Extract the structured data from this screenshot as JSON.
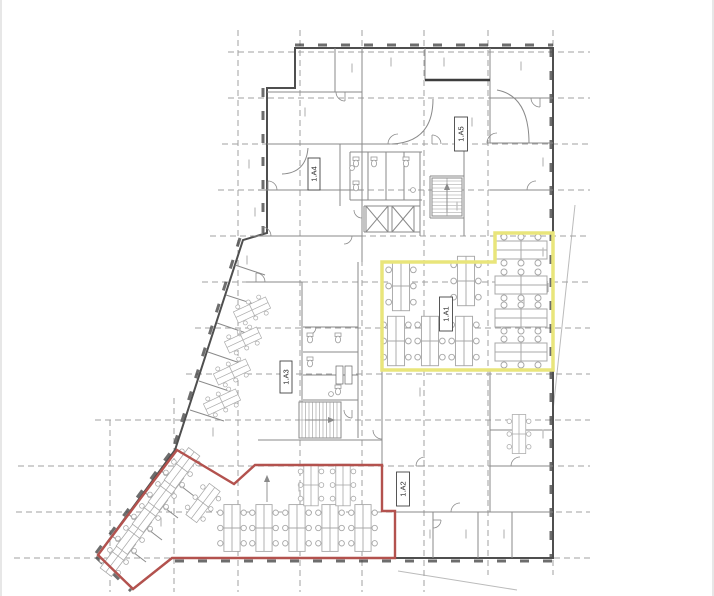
{
  "title": "architectural-floor-plan",
  "colors": {
    "background": "#ffffff",
    "grid": "#a0a0a0",
    "wall_exterior": "#4f4f4f",
    "wall_interior": "#8a8a8a",
    "wall_dark": "#3d3d3d",
    "furniture": "#a8a8a8",
    "zone_yellow": "#e9e57b",
    "zone_red": "#b3524e",
    "label_text": "#2b2b2b",
    "label_box_border": "#444444",
    "site_line": "#bbbbbb",
    "micro": "#bfbfbf",
    "fixture": "#9a9a9a",
    "page_edge": "#e7e7e7"
  },
  "grid": {
    "verticals": [
      {
        "x": 238,
        "y1": 30,
        "y2": 592
      },
      {
        "x": 300,
        "y1": 30,
        "y2": 592
      },
      {
        "x": 362,
        "y1": 30,
        "y2": 592
      },
      {
        "x": 424,
        "y1": 30,
        "y2": 592
      },
      {
        "x": 488,
        "y1": 30,
        "y2": 575
      },
      {
        "x": 553,
        "y1": 30,
        "y2": 575
      },
      {
        "x": 174,
        "y1": 398,
        "y2": 592
      },
      {
        "x": 110,
        "y1": 420,
        "y2": 592
      }
    ],
    "horizontals": [
      {
        "y": 52,
        "x1": 228,
        "x2": 590
      },
      {
        "y": 98,
        "x1": 228,
        "x2": 590
      },
      {
        "y": 144,
        "x1": 222,
        "x2": 590
      },
      {
        "y": 190,
        "x1": 218,
        "x2": 590
      },
      {
        "y": 236,
        "x1": 210,
        "x2": 590
      },
      {
        "y": 282,
        "x1": 202,
        "x2": 590
      },
      {
        "y": 328,
        "x1": 195,
        "x2": 590
      },
      {
        "y": 374,
        "x1": 186,
        "x2": 590
      },
      {
        "y": 420,
        "x1": 95,
        "x2": 590
      },
      {
        "y": 466,
        "x1": 18,
        "x2": 590
      },
      {
        "y": 512,
        "x1": 16,
        "x2": 590
      },
      {
        "y": 558,
        "x1": 14,
        "x2": 590
      }
    ]
  },
  "outline": "M 295 48 L 553 48 L 553 558 L 172 558 L 133 589 L 98 555 L 175 450 L 243 240 L 267 233 L 267 88 L 295 88 Z",
  "window_strips": [
    [
      295,
      45,
      553,
      45
    ],
    [
      551,
      48,
      551,
      558
    ],
    [
      175,
      561,
      553,
      561
    ],
    [
      240,
      238,
      174,
      446
    ],
    [
      96,
      553,
      173,
      449
    ],
    [
      96,
      557,
      131,
      591
    ],
    [
      263,
      88,
      263,
      233
    ]
  ],
  "interior_walls": [
    [
      362,
      48,
      362,
      262
    ],
    [
      335,
      48,
      335,
      92
    ],
    [
      267,
      92,
      362,
      92
    ],
    [
      425,
      48,
      425,
      80
    ],
    [
      490,
      48,
      490,
      143
    ],
    [
      267,
      144,
      390,
      144
    ],
    [
      490,
      143,
      553,
      143
    ],
    [
      490,
      98,
      553,
      98
    ],
    [
      258,
      190,
      362,
      190
    ],
    [
      490,
      190,
      553,
      190
    ],
    [
      252,
      236,
      362,
      236
    ],
    [
      340,
      144,
      340,
      206
    ],
    [
      420,
      152,
      420,
      236
    ],
    [
      464,
      144,
      464,
      236
    ],
    [
      350,
      152,
      422,
      152
    ],
    [
      350,
      200,
      422,
      200
    ],
    [
      350,
      152,
      350,
      200
    ],
    [
      368,
      152,
      368,
      200
    ],
    [
      386,
      152,
      386,
      200
    ],
    [
      404,
      152,
      404,
      200
    ],
    [
      302,
      282,
      302,
      438
    ],
    [
      246,
      282,
      302,
      282
    ],
    [
      358,
      262,
      358,
      438
    ],
    [
      303,
      327,
      358,
      327
    ],
    [
      303,
      352,
      358,
      352
    ],
    [
      303,
      375,
      358,
      375
    ],
    [
      303,
      400,
      358,
      400
    ],
    [
      299,
      402,
      341,
      402
    ],
    [
      341,
      402,
      341,
      438
    ],
    [
      299,
      438,
      341,
      438
    ],
    [
      382,
      262,
      495,
      262
    ],
    [
      495,
      233,
      553,
      233
    ],
    [
      382,
      262,
      382,
      370
    ],
    [
      382,
      370,
      553,
      370
    ],
    [
      382,
      370,
      382,
      465
    ],
    [
      258,
      440,
      382,
      440
    ],
    [
      395,
      512,
      553,
      512
    ],
    [
      433,
      512,
      433,
      558
    ],
    [
      478,
      512,
      478,
      558
    ],
    [
      512,
      512,
      512,
      558
    ],
    [
      490,
      370,
      490,
      512
    ],
    [
      490,
      430,
      553,
      430
    ],
    [
      490,
      466,
      553,
      466
    ],
    [
      430,
      176,
      464,
      176
    ],
    [
      430,
      218,
      464,
      218
    ],
    [
      430,
      176,
      430,
      218
    ],
    [
      364,
      206,
      364,
      232
    ],
    [
      420,
      206,
      420,
      232
    ],
    [
      364,
      206,
      420,
      206
    ],
    [
      364,
      232,
      420,
      232
    ],
    [
      235,
      265,
      265,
      275
    ],
    [
      226,
      295,
      257,
      305
    ],
    [
      217,
      323,
      249,
      334
    ],
    [
      208,
      352,
      240,
      363
    ],
    [
      199,
      381,
      232,
      392
    ],
    [
      190,
      410,
      224,
      421
    ],
    [
      112,
      536,
      146,
      562
    ],
    [
      128,
      514,
      162,
      540
    ],
    [
      144,
      492,
      178,
      518
    ],
    [
      160,
      470,
      194,
      496
    ]
  ],
  "dark_walls": [
    [
      425,
      80,
      490,
      80
    ]
  ],
  "arcs": [
    "M 433 99 Q 433 142 392 144",
    "M 497 90 Q 529 96 529 143",
    "M 308 148 Q 306 173 282 174"
  ],
  "doors": [
    [
      345,
      92,
      9,
      90
    ],
    [
      398,
      144,
      10,
      180
    ],
    [
      432,
      144,
      9,
      270
    ],
    [
      497,
      143,
      10,
      180
    ],
    [
      536,
      190,
      9,
      180
    ],
    [
      268,
      190,
      9,
      270
    ],
    [
      262,
      236,
      9,
      270
    ],
    [
      256,
      282,
      9,
      270
    ],
    [
      362,
      210,
      8,
      90
    ],
    [
      344,
      236,
      8,
      0
    ],
    [
      308,
      327,
      8,
      0
    ],
    [
      352,
      410,
      8,
      90
    ],
    [
      382,
      430,
      9,
      90
    ],
    [
      425,
      466,
      9,
      180
    ],
    [
      460,
      512,
      9,
      180
    ],
    [
      433,
      520,
      8,
      0
    ],
    [
      520,
      466,
      9,
      180
    ],
    [
      548,
      283,
      9,
      90
    ],
    [
      540,
      98,
      9,
      90
    ]
  ],
  "stairs": [
    {
      "x": 432,
      "y": 178,
      "w": 30,
      "h": 38,
      "dir": "h"
    },
    {
      "x": 299,
      "y": 402,
      "w": 42,
      "h": 36,
      "dir": "v"
    }
  ],
  "elevators": [
    {
      "x": 366,
      "y": 206,
      "w": 22,
      "h": 26
    },
    {
      "x": 392,
      "y": 206,
      "w": 22,
      "h": 26
    }
  ],
  "fixtures": {
    "wc": [
      [
        356,
        162
      ],
      [
        356,
        186
      ],
      [
        374,
        162
      ],
      [
        406,
        162
      ],
      [
        310,
        338
      ],
      [
        310,
        362
      ],
      [
        338,
        338
      ],
      [
        338,
        390
      ]
    ],
    "basins": [
      [
        413,
        190
      ],
      [
        331,
        394
      ],
      [
        352,
        168
      ]
    ]
  },
  "desk_clusters": [
    {
      "cx": 521,
      "cy": 250,
      "rot": 0,
      "s": 1
    },
    {
      "cx": 521,
      "cy": 285,
      "rot": 0,
      "s": 1
    },
    {
      "cx": 521,
      "cy": 318,
      "rot": 0,
      "s": 1
    },
    {
      "cx": 521,
      "cy": 352,
      "rot": 0,
      "s": 1
    },
    {
      "cx": 401,
      "cy": 286,
      "rot": 90,
      "s": 0.95
    },
    {
      "cx": 466,
      "cy": 281,
      "rot": 90,
      "s": 0.95
    },
    {
      "cx": 396,
      "cy": 341,
      "rot": 90,
      "s": 0.95
    },
    {
      "cx": 430,
      "cy": 341,
      "rot": 90,
      "s": 0.95
    },
    {
      "cx": 464,
      "cy": 341,
      "rot": 90,
      "s": 0.95
    },
    {
      "cx": 232,
      "cy": 528,
      "rot": 90,
      "s": 0.9
    },
    {
      "cx": 264,
      "cy": 528,
      "rot": 90,
      "s": 0.9
    },
    {
      "cx": 297,
      "cy": 528,
      "rot": 90,
      "s": 0.9
    },
    {
      "cx": 330,
      "cy": 528,
      "rot": 90,
      "s": 0.9
    },
    {
      "cx": 363,
      "cy": 528,
      "rot": 90,
      "s": 0.9
    },
    {
      "cx": 311,
      "cy": 485,
      "rot": 90,
      "s": 0.8
    },
    {
      "cx": 343,
      "cy": 485,
      "rot": 90,
      "s": 0.8
    },
    {
      "cx": 118,
      "cy": 556,
      "rot": -53,
      "s": 0.78
    },
    {
      "cx": 134,
      "cy": 534,
      "rot": -53,
      "s": 0.78
    },
    {
      "cx": 150,
      "cy": 512,
      "rot": -53,
      "s": 0.78
    },
    {
      "cx": 166,
      "cy": 490,
      "rot": -53,
      "s": 0.78
    },
    {
      "cx": 182,
      "cy": 468,
      "rot": -53,
      "s": 0.78
    },
    {
      "cx": 203,
      "cy": 503,
      "rot": -53,
      "s": 0.75
    },
    {
      "cx": 222,
      "cy": 402,
      "rot": -25,
      "s": 0.68
    },
    {
      "cx": 232,
      "cy": 372,
      "rot": -25,
      "s": 0.68
    },
    {
      "cx": 243,
      "cy": 340,
      "rot": -25,
      "s": 0.68
    },
    {
      "cx": 252,
      "cy": 310,
      "rot": -25,
      "s": 0.68
    },
    {
      "cx": 519,
      "cy": 434,
      "rot": 90,
      "s": 0.75
    }
  ],
  "zones": [
    {
      "id": "zone-1a1",
      "label_ref": "1.A1",
      "color_key": "zone_yellow",
      "stroke_width": 3.5,
      "points": "382,262 495,262 495,233 553,233 553,370 382,370"
    },
    {
      "id": "zone-1a2",
      "label_ref": "1.A2",
      "color_key": "zone_red",
      "stroke_width": 2.4,
      "points": "177,450 234,484 255,465 382,465 382,511 395,511 395,558 172,558 133,589 98,555"
    }
  ],
  "area_labels": [
    {
      "id": "1a1",
      "text": "1.A1",
      "cx": 446,
      "cy": 314,
      "w": 13,
      "h": 34
    },
    {
      "id": "1a2",
      "text": "1.A2",
      "cx": 403,
      "cy": 489,
      "w": 13,
      "h": 34
    },
    {
      "id": "1a3",
      "text": "1.A3",
      "cx": 286,
      "cy": 377,
      "w": 12,
      "h": 32
    },
    {
      "id": "1a4",
      "text": "1.A4",
      "cx": 314,
      "cy": 174,
      "w": 12,
      "h": 32
    },
    {
      "id": "1a5",
      "text": "1.A5",
      "cx": 461,
      "cy": 134,
      "w": 13,
      "h": 34
    }
  ],
  "tag_boxes": [
    [
      336,
      366,
      7,
      18
    ],
    [
      345,
      366,
      7,
      18
    ]
  ],
  "micro_labels": [
    [
      305,
      112
    ],
    [
      352,
      68
    ],
    [
      391,
      62
    ],
    [
      444,
      62
    ],
    [
      472,
      122
    ],
    [
      521,
      66
    ],
    [
      543,
      162
    ],
    [
      249,
      164
    ],
    [
      255,
      212
    ],
    [
      247,
      260
    ],
    [
      524,
      302
    ],
    [
      543,
      434
    ],
    [
      420,
      392
    ],
    [
      299,
      487
    ],
    [
      430,
      534
    ],
    [
      466,
      534
    ],
    [
      504,
      534
    ],
    [
      240,
      332
    ],
    [
      213,
      432
    ],
    [
      161,
      522
    ],
    [
      457,
      206
    ],
    [
      543,
      252
    ]
  ],
  "site_lines": [
    [
      575,
      205,
      552,
      420
    ],
    [
      398,
      571,
      517,
      590
    ]
  ],
  "arrows": [
    [
      267,
      502,
      267,
      476
    ],
    [
      305,
      420,
      334,
      420
    ],
    [
      447,
      212,
      447,
      184
    ]
  ]
}
